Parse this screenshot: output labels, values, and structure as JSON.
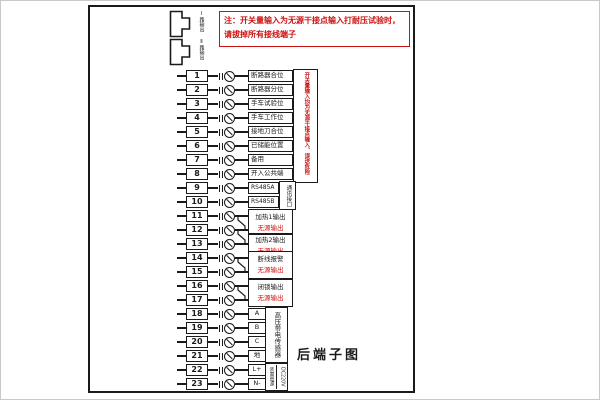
{
  "colors": {
    "line": "#1a1a1a",
    "warning_red": "#cc1111"
  },
  "note": {
    "line1": "注：开关量输入为无源干接点输入打耐压试验时，",
    "line2": "请拔掉所有接线端子"
  },
  "connectors": {
    "items": [
      {
        "label": "Ⅰ路输出"
      },
      {
        "label": "Ⅱ路输出"
      }
    ]
  },
  "side_warning": "开关量输入均为无源干接点输入、误送危险",
  "title": "后端子图",
  "terminals": {
    "rows": [
      {
        "no": "1",
        "label": "断路器合位",
        "type": "wide"
      },
      {
        "no": "2",
        "label": "断路器分位",
        "type": "wide"
      },
      {
        "no": "3",
        "label": "手车试验位",
        "type": "wide"
      },
      {
        "no": "4",
        "label": "手车工作位",
        "type": "wide"
      },
      {
        "no": "5",
        "label": "接地刀合位",
        "type": "wide"
      },
      {
        "no": "6",
        "label": "已储能位置",
        "type": "wide"
      },
      {
        "no": "7",
        "label": "备用",
        "type": "wide"
      },
      {
        "no": "8",
        "label": "开入公共端",
        "type": "wide"
      },
      {
        "no": "9",
        "label": "RS485A",
        "type": "med"
      },
      {
        "no": "10",
        "label": "RS485B",
        "type": "med"
      },
      {
        "no": "11",
        "label": "",
        "type": "none"
      },
      {
        "no": "12",
        "label": "",
        "type": "none"
      },
      {
        "no": "13",
        "label": "",
        "type": "none"
      },
      {
        "no": "14",
        "label": "",
        "type": "none"
      },
      {
        "no": "15",
        "label": "",
        "type": "none"
      },
      {
        "no": "16",
        "label": "",
        "type": "none"
      },
      {
        "no": "17",
        "label": "",
        "type": "none"
      },
      {
        "no": "18",
        "label": "A",
        "type": "narrow"
      },
      {
        "no": "19",
        "label": "B",
        "type": "narrow"
      },
      {
        "no": "20",
        "label": "C",
        "type": "narrow"
      },
      {
        "no": "21",
        "label": "地",
        "type": "narrow"
      },
      {
        "no": "22",
        "label": "L+",
        "type": "narrow"
      },
      {
        "no": "23",
        "label": "N-",
        "type": "narrow"
      }
    ],
    "groups": [
      {
        "line1": "加热1输出",
        "line2": "无源输出",
        "rows": [
          11,
          12
        ]
      },
      {
        "line1": "加热2输出",
        "line2": "无源输出",
        "rows": [
          12,
          13
        ]
      },
      {
        "line1": "断线报警",
        "line2": "无源输出",
        "rows": [
          14,
          15
        ]
      },
      {
        "line1": "闭锁输出",
        "line2": "无源输出",
        "rows": [
          16,
          17
        ]
      }
    ],
    "contact_pairs": [
      [
        11,
        12
      ],
      [
        12,
        13
      ],
      [
        14,
        15
      ],
      [
        16,
        17
      ]
    ],
    "brackets": [
      {
        "text": "通讯接口",
        "rows": [
          9,
          10
        ]
      },
      {
        "text": "高压带电传感器",
        "rows": [
          18,
          21
        ]
      },
      {
        "text": "DC220V",
        "text2": "装置电源",
        "rows": [
          22,
          23
        ]
      }
    ]
  }
}
